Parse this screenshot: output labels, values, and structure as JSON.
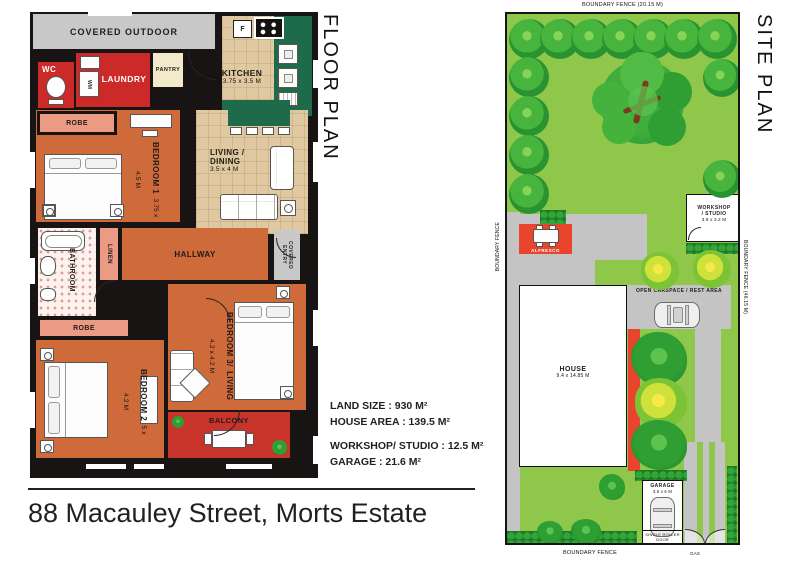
{
  "titles": {
    "floor_plan": "FLOOR PLAN",
    "site_plan": "SITE PLAN"
  },
  "address": "88 Macauley Street, Morts Estate",
  "summary": {
    "land_size": "LAND SIZE : 930 M²",
    "house_area": "HOUSE AREA : 139.5 M²",
    "workshop_studio": "WORKSHOP/ STUDIO : 12.5 M²",
    "garage": "GARAGE : 21.6 M²"
  },
  "floor_plan": {
    "covered_outdoor": "COVERED OUTDOOR",
    "wc": "WC",
    "laundry": "LAUNDRY",
    "wm": "WM",
    "pantry": "PANTRY",
    "fridge": "F",
    "kitchen": {
      "name": "KITCHEN",
      "dims": "3.75 x 3.5 M"
    },
    "robe1": "ROBE",
    "bedroom1": {
      "name": "BEDROOM 1",
      "dims": "3.75 x 4.5 M"
    },
    "living": {
      "line1": "LIVING /",
      "line2": "DINING",
      "dims": "3.5 x 4 M"
    },
    "bathroom": "BATHROOM",
    "linen": "LINEN",
    "hallway": "HALLWAY",
    "covered_entry": {
      "line1": "COVERED",
      "line2": "ENTRY"
    },
    "robe2": "ROBE",
    "bedroom3": {
      "name": "BEDROOM 3/",
      "name2": "LIVING",
      "dims": "4.2 x 4.2 M"
    },
    "bedroom2": {
      "name": "BEDROOM 2",
      "dims": "5 x 4.2 M"
    },
    "balcony": "BALCONY"
  },
  "site_plan": {
    "fence_top": "BOUNDARY FENCE (20.15 M)",
    "fence_left": "BOUNDARY FENCE",
    "fence_right": "BOUNDARY FENCE (46.15 M)",
    "fence_bottom": "BOUNDARY FENCE",
    "workshop": {
      "line1": "WORKSHOP",
      "line2": "/ STUDIO",
      "dims": "3.9 x 3.2 M"
    },
    "alfresco": "ALFRESCO",
    "carspace": "OPEN CARSPACE / REST AREA",
    "house": {
      "name": "HOUSE",
      "dims": "9.4 x 14.85 M"
    },
    "garage": {
      "name": "GARAGE",
      "dims": "3.6 x 6 M"
    },
    "roller_door": "SINGLE ROLLER DOOR",
    "gas": "GAS"
  },
  "colors": {
    "wall": "#181413",
    "room_orange": "#cf6a3a",
    "room_red": "#cc2a28",
    "room_salmon": "#eb9b84",
    "room_tan": "#e0c9a1",
    "counter_green": "#1e6b4b",
    "covered_gray": "#c8c8c8",
    "lawn_green": "#8fc74a",
    "bush_green": "#2f9e33",
    "path_gray": "#c4c4c4",
    "accent_red": "#e8442e"
  }
}
